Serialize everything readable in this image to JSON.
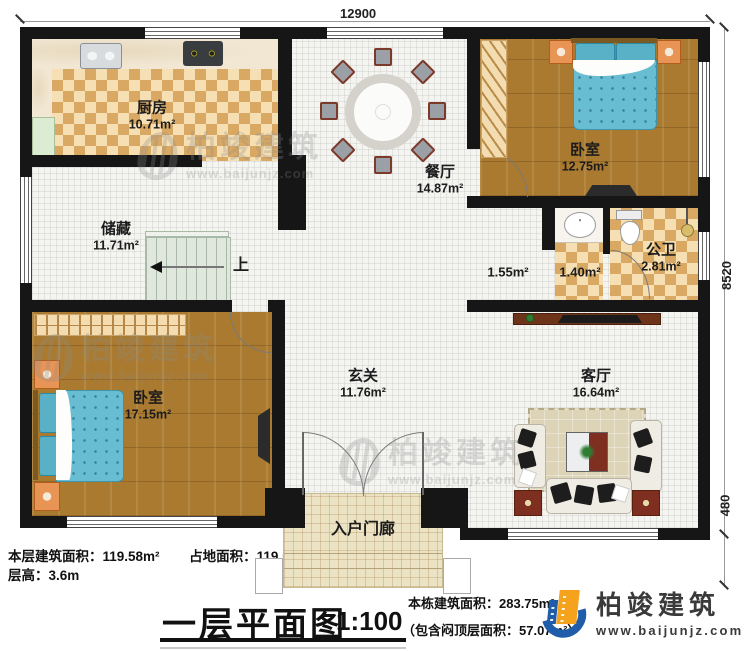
{
  "dims": {
    "top": "12900",
    "right_main": "8520",
    "right_porch": "480"
  },
  "rooms": {
    "kitchen": {
      "name": "厨房",
      "area": "10.71m²"
    },
    "dining": {
      "name": "餐厅",
      "area": "14.87m²"
    },
    "bedroom_top": {
      "name": "卧室",
      "area": "12.75m²"
    },
    "storage": {
      "name": "储藏",
      "area": "11.71m²"
    },
    "lobby": {
      "area": "1.55m²"
    },
    "vestibule": {
      "area": "1.40m²"
    },
    "bath": {
      "name": "公卫",
      "area": "2.81m²"
    },
    "bedroom_bottom": {
      "name": "卧室",
      "area": "17.15m²"
    },
    "hall": {
      "name": "玄关",
      "area": "11.76m²"
    },
    "living": {
      "name": "客厅",
      "area": "16.64m²"
    },
    "porch": {
      "name": "入户门廊"
    }
  },
  "stairs": {
    "up": "上"
  },
  "footer": {
    "floor_area_label": "本层建筑面积：119.58m²",
    "land_area_label": "占地面积：119.58m²",
    "height_label": "层高：3.6m",
    "title": "一层平面图",
    "scale": "1:100",
    "total_area": "本栋建筑面积：283.75m²",
    "attic_area": "（包含闷顶层面积：57.07m²）"
  },
  "brand": {
    "name": "柏竣建筑",
    "url": "www.baijunjz.com"
  },
  "watermark": {
    "name": "柏竣建筑",
    "url": "www.baijunjz.com"
  },
  "colors": {
    "wall": "#161616",
    "wood": "#a97a30",
    "tile": "#d9a963",
    "brand_blue": "#1f5dab",
    "brand_orange": "#f5a21c"
  }
}
